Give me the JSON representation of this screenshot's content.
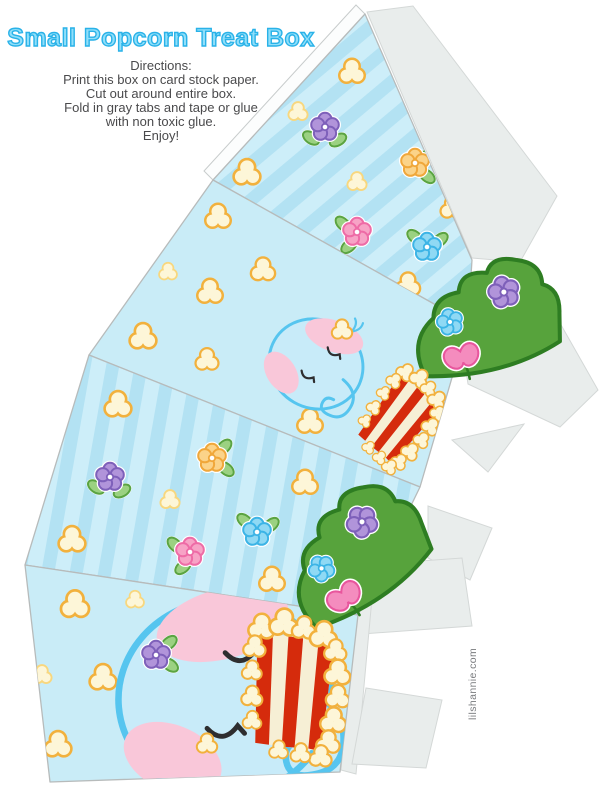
{
  "page": {
    "title": "Small Popcorn Treat Box",
    "watermark": "lilshannie.com"
  },
  "directions": {
    "heading": "Directions:",
    "lines": [
      "Print this box on card stock paper.",
      "Cut out around entire box.",
      "Fold in gray tabs and tape or glue",
      "with non toxic glue.",
      "Enjoy!"
    ]
  },
  "colors": {
    "accent_blue": "#29b2e8",
    "title_fill": "#90dffa",
    "panel_blue": "#c9ecf7",
    "stripe_light": "#cdeef9",
    "stripe_dark": "#b3e2f3",
    "popcorn_cream": "#fdf6d8",
    "popcorn_orange": "#f2b13d",
    "popcorn_soft": "#f8d77e",
    "box_red": "#d52b0c",
    "box_cream": "#f6efd5",
    "grass_green": "#57a33c",
    "tab_gray": "#e9edec",
    "text_gray": "#4a4a4c",
    "watermark_gray": "#797b7e",
    "elephant_blue": "#c8ebf9",
    "elephant_outline": "#56c5ef",
    "ear_pink": "#f9c7d9"
  }
}
